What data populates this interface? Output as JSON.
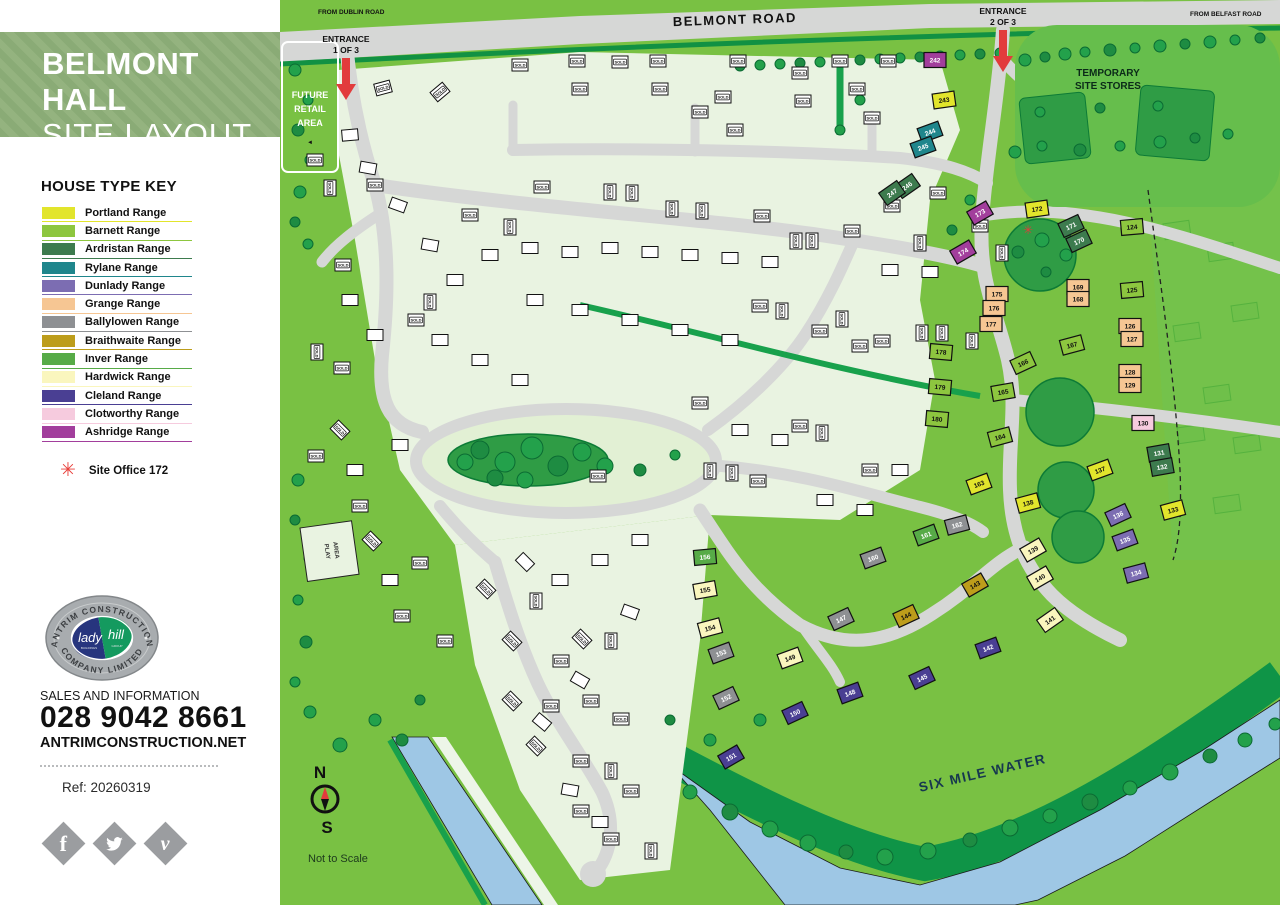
{
  "sidebar": {
    "title_line1": "BELMONT HALL",
    "title_line2": "SITE LAYOUT",
    "key_title": "HOUSE TYPE KEY",
    "key": [
      {
        "label": "Portland Range",
        "color": "#e2e52c",
        "text": "#111111"
      },
      {
        "label": "Barnett Range",
        "color": "#8dc63f",
        "text": "#111111"
      },
      {
        "label": "Ardristan Range",
        "color": "#3d7b4e",
        "text": "#ffffff"
      },
      {
        "label": "Rylane Range",
        "color": "#1f868c",
        "text": "#ffffff"
      },
      {
        "label": "Dunlady Range",
        "color": "#7c6db2",
        "text": "#ffffff"
      },
      {
        "label": "Grange Range",
        "color": "#f6c693",
        "text": "#111111"
      },
      {
        "label": "Ballylowen Range",
        "color": "#8e9093",
        "text": "#ffffff"
      },
      {
        "label": "Braithwaite Range",
        "color": "#bd9d1b",
        "text": "#111111"
      },
      {
        "label": "Inver Range",
        "color": "#57ab47",
        "text": "#ffffff"
      },
      {
        "label": "Hardwick Range",
        "color": "#faf6be",
        "text": "#111111"
      },
      {
        "label": "Cleland Range",
        "color": "#4a3f93",
        "text": "#ffffff"
      },
      {
        "label": "Clotworthy Range",
        "color": "#f6cbde",
        "text": "#111111"
      },
      {
        "label": "Ashridge Range",
        "color": "#a23e9c",
        "text": "#ffffff"
      }
    ],
    "site_office_label": "Site Office 172",
    "site_office_symbol": "✳",
    "logo": {
      "arc_top": "ANTRIM CONSTRUCTION",
      "arc_bottom": "COMPANY LIMITED",
      "script_left": "lady",
      "script_right": "hill",
      "sub_left": "BUILDINGS",
      "sub_right": "GROUP"
    },
    "sales_label": "SALES AND INFORMATION",
    "phone": "028 9042 8661",
    "website": "ANTRIMCONSTRUCTION.NET",
    "ref": "Ref: 20260319",
    "social": [
      "facebook",
      "twitter",
      "vimeo"
    ]
  },
  "map": {
    "labels": {
      "belmont_road": "BELMONT ROAD",
      "from_dublin": "FROM DUBLIN ROAD",
      "from_belfast": "FROM BELFAST ROAD",
      "entrance": "ENTRANCE",
      "entrance1_sub": "1 OF 3",
      "entrance2_sub": "2 OF 3",
      "future_retail_1": "FUTURE",
      "future_retail_2": "RETAIL",
      "future_retail_3": "AREA",
      "stores_1": "TEMPORARY",
      "stores_2": "SITE STORES",
      "six_mile_water": "SIX MILE WATER",
      "play_area_1": "PLAY",
      "play_area_2": "AREA",
      "compass_n": "N",
      "compass_s": "S",
      "not_to_scale": "Not to Scale",
      "sold": "SOLD",
      "site_office_symbol": "✳"
    },
    "colors": {
      "grass": "#79c143",
      "future_field": "#74c24b",
      "road": "#d6d7d6",
      "dev": "#e9f3e1",
      "river": "#9ec7e5",
      "bank": "#0f9447",
      "tree": "#23a14b",
      "tree_dark": "#0d7b36",
      "red": "#e23b3c"
    },
    "plots": [
      [
        "242",
        655,
        60,
        0,
        12
      ],
      [
        "243",
        664,
        100,
        -8,
        0
      ],
      [
        "244",
        650,
        132,
        -20,
        3
      ],
      [
        "245",
        643,
        147,
        -20,
        3
      ],
      [
        "246",
        627,
        186,
        -35,
        2
      ],
      [
        "247",
        612,
        193,
        -35,
        2
      ],
      [
        "173",
        700,
        213,
        -30,
        12
      ],
      [
        "174",
        683,
        252,
        -30,
        12
      ],
      [
        "172",
        757,
        209,
        -8,
        0
      ],
      [
        "171",
        791,
        226,
        -25,
        2
      ],
      [
        "170",
        799,
        241,
        -25,
        2
      ],
      [
        "124",
        852,
        227,
        -5,
        1
      ],
      [
        "175",
        717,
        294,
        0,
        5
      ],
      [
        "176",
        714,
        308,
        0,
        5
      ],
      [
        "177",
        711,
        324,
        0,
        5
      ],
      [
        "169",
        798,
        287,
        0,
        5
      ],
      [
        "168",
        798,
        299,
        0,
        5
      ],
      [
        "125",
        852,
        290,
        -5,
        1
      ],
      [
        "126",
        850,
        326,
        0,
        5
      ],
      [
        "127",
        852,
        339,
        0,
        5
      ],
      [
        "178",
        661,
        352,
        5,
        1
      ],
      [
        "179",
        660,
        387,
        5,
        1
      ],
      [
        "180",
        657,
        419,
        5,
        1
      ],
      [
        "167",
        792,
        345,
        -15,
        1
      ],
      [
        "166",
        743,
        363,
        -25,
        1
      ],
      [
        "165",
        723,
        392,
        -10,
        1
      ],
      [
        "164",
        720,
        437,
        -15,
        1
      ],
      [
        "163",
        699,
        484,
        -20,
        0
      ],
      [
        "128",
        850,
        372,
        0,
        5
      ],
      [
        "129",
        850,
        385,
        0,
        5
      ],
      [
        "130",
        863,
        423,
        0,
        11
      ],
      [
        "131",
        879,
        453,
        -10,
        2
      ],
      [
        "132",
        882,
        467,
        -10,
        2
      ],
      [
        "133",
        893,
        510,
        -15,
        0
      ],
      [
        "137",
        820,
        470,
        -20,
        0
      ],
      [
        "138",
        748,
        503,
        -15,
        0
      ],
      [
        "136",
        838,
        515,
        -25,
        4
      ],
      [
        "135",
        845,
        540,
        -20,
        4
      ],
      [
        "134",
        856,
        573,
        -15,
        4
      ],
      [
        "139",
        753,
        550,
        -30,
        9
      ],
      [
        "140",
        760,
        578,
        -30,
        9
      ],
      [
        "141",
        770,
        620,
        -35,
        9
      ],
      [
        "143",
        695,
        585,
        -30,
        7
      ],
      [
        "144",
        626,
        616,
        -25,
        7
      ],
      [
        "142",
        708,
        648,
        -20,
        10
      ],
      [
        "145",
        642,
        678,
        -25,
        10
      ],
      [
        "148",
        570,
        693,
        -20,
        10
      ],
      [
        "150",
        515,
        713,
        -25,
        10
      ],
      [
        "151",
        451,
        757,
        -30,
        10
      ],
      [
        "149",
        510,
        658,
        -20,
        9
      ],
      [
        "147",
        561,
        619,
        -25,
        6
      ],
      [
        "160",
        593,
        558,
        -20,
        6
      ],
      [
        "162",
        677,
        525,
        -15,
        6
      ],
      [
        "161",
        646,
        535,
        -20,
        8
      ],
      [
        "152",
        446,
        698,
        -25,
        6
      ],
      [
        "153",
        441,
        653,
        -20,
        6
      ],
      [
        "154",
        430,
        628,
        -15,
        9
      ],
      [
        "155",
        425,
        590,
        -10,
        9
      ],
      [
        "156",
        425,
        557,
        -5,
        8
      ]
    ],
    "sold_houses": [
      [
        103,
        88,
        -15
      ],
      [
        160,
        92,
        -40
      ],
      [
        240,
        65,
        0
      ],
      [
        297,
        61,
        0
      ],
      [
        300,
        89,
        0
      ],
      [
        340,
        62,
        0
      ],
      [
        378,
        61,
        0
      ],
      [
        380,
        89,
        0
      ],
      [
        420,
        112,
        0
      ],
      [
        443,
        97,
        0
      ],
      [
        458,
        61,
        0
      ],
      [
        455,
        130,
        0
      ],
      [
        520,
        73,
        0
      ],
      [
        523,
        101,
        0
      ],
      [
        560,
        61,
        0
      ],
      [
        577,
        89,
        0
      ],
      [
        592,
        118,
        0
      ],
      [
        608,
        61,
        0
      ],
      [
        35,
        160,
        0
      ],
      [
        50,
        188,
        90
      ],
      [
        95,
        185,
        0
      ],
      [
        63,
        265,
        0
      ],
      [
        37,
        352,
        90
      ],
      [
        62,
        368,
        0
      ],
      [
        150,
        302,
        90
      ],
      [
        136,
        320,
        0
      ],
      [
        190,
        215,
        0
      ],
      [
        230,
        227,
        90
      ],
      [
        262,
        187,
        0
      ],
      [
        330,
        192,
        90
      ],
      [
        352,
        193,
        90
      ],
      [
        392,
        209,
        90
      ],
      [
        422,
        211,
        90
      ],
      [
        482,
        216,
        0
      ],
      [
        516,
        241,
        90
      ],
      [
        532,
        241,
        90
      ],
      [
        572,
        231,
        0
      ],
      [
        612,
        206,
        0
      ],
      [
        640,
        243,
        90
      ],
      [
        658,
        193,
        0
      ],
      [
        700,
        226,
        0
      ],
      [
        722,
        253,
        90
      ],
      [
        480,
        306,
        0
      ],
      [
        502,
        311,
        90
      ],
      [
        540,
        331,
        0
      ],
      [
        562,
        319,
        90
      ],
      [
        602,
        341,
        0
      ],
      [
        642,
        333,
        90
      ],
      [
        662,
        333,
        90
      ],
      [
        692,
        341,
        90
      ],
      [
        580,
        346,
        0
      ],
      [
        420,
        403,
        0
      ],
      [
        520,
        426,
        0
      ],
      [
        542,
        433,
        90
      ],
      [
        318,
        476,
        0
      ],
      [
        430,
        471,
        90
      ],
      [
        452,
        473,
        90
      ],
      [
        478,
        481,
        0
      ],
      [
        590,
        470,
        0
      ],
      [
        60,
        430,
        45
      ],
      [
        36,
        456,
        0
      ],
      [
        80,
        506,
        0
      ],
      [
        92,
        541,
        45
      ],
      [
        140,
        563,
        0
      ],
      [
        206,
        589,
        45
      ],
      [
        232,
        641,
        45
      ],
      [
        165,
        641,
        0
      ],
      [
        122,
        616,
        0
      ],
      [
        256,
        601,
        90
      ],
      [
        281,
        661,
        0
      ],
      [
        302,
        639,
        45
      ],
      [
        331,
        641,
        90
      ],
      [
        232,
        701,
        45
      ],
      [
        271,
        706,
        0
      ],
      [
        311,
        701,
        0
      ],
      [
        341,
        719,
        0
      ],
      [
        256,
        746,
        45
      ],
      [
        301,
        761,
        0
      ],
      [
        331,
        771,
        90
      ],
      [
        351,
        791,
        0
      ],
      [
        301,
        811,
        0
      ],
      [
        331,
        839,
        0
      ],
      [
        371,
        851,
        90
      ]
    ],
    "houses": [
      [
        70,
        135,
        -5
      ],
      [
        88,
        168,
        10
      ],
      [
        118,
        205,
        20
      ],
      [
        150,
        245,
        10
      ],
      [
        175,
        280,
        0
      ],
      [
        70,
        300,
        0
      ],
      [
        95,
        335,
        0
      ],
      [
        210,
        255,
        0
      ],
      [
        250,
        248,
        0
      ],
      [
        290,
        252,
        0
      ],
      [
        330,
        248,
        0
      ],
      [
        370,
        252,
        0
      ],
      [
        410,
        255,
        0
      ],
      [
        450,
        258,
        0
      ],
      [
        490,
        262,
        0
      ],
      [
        255,
        300,
        0
      ],
      [
        300,
        310,
        0
      ],
      [
        350,
        320,
        0
      ],
      [
        400,
        330,
        0
      ],
      [
        450,
        340,
        0
      ],
      [
        610,
        270,
        0
      ],
      [
        650,
        272,
        0
      ],
      [
        160,
        340,
        0
      ],
      [
        200,
        360,
        0
      ],
      [
        240,
        380,
        0
      ],
      [
        120,
        445,
        0
      ],
      [
        460,
        430,
        0
      ],
      [
        500,
        440,
        0
      ],
      [
        360,
        540,
        0
      ],
      [
        320,
        560,
        0
      ],
      [
        280,
        580,
        0
      ],
      [
        245,
        562,
        45
      ],
      [
        350,
        612,
        20
      ],
      [
        300,
        680,
        30
      ],
      [
        262,
        722,
        40
      ],
      [
        290,
        790,
        10
      ],
      [
        320,
        822,
        0
      ],
      [
        110,
        580,
        0
      ],
      [
        75,
        470,
        0
      ],
      [
        545,
        500,
        0
      ],
      [
        585,
        510,
        0
      ],
      [
        620,
        470,
        0
      ]
    ],
    "trees": [
      [
        460,
        66,
        5
      ],
      [
        480,
        65,
        5
      ],
      [
        500,
        64,
        5
      ],
      [
        520,
        63,
        5
      ],
      [
        540,
        62,
        5
      ],
      [
        560,
        61,
        5
      ],
      [
        580,
        60,
        5
      ],
      [
        600,
        59,
        5
      ],
      [
        620,
        58,
        5
      ],
      [
        640,
        57,
        5
      ],
      [
        660,
        56,
        5
      ],
      [
        680,
        55,
        5
      ],
      [
        700,
        54,
        5
      ],
      [
        720,
        53,
        5
      ],
      [
        745,
        60,
        6
      ],
      [
        765,
        57,
        5
      ],
      [
        785,
        54,
        6
      ],
      [
        805,
        52,
        5
      ],
      [
        830,
        50,
        6
      ],
      [
        855,
        48,
        5
      ],
      [
        880,
        46,
        6
      ],
      [
        905,
        44,
        5
      ],
      [
        930,
        42,
        6
      ],
      [
        955,
        40,
        5
      ],
      [
        980,
        38,
        5
      ],
      [
        15,
        70,
        6
      ],
      [
        28,
        100,
        5
      ],
      [
        18,
        130,
        6
      ],
      [
        30,
        160,
        5
      ],
      [
        20,
        192,
        6
      ],
      [
        15,
        222,
        5
      ],
      [
        28,
        244,
        5
      ],
      [
        18,
        480,
        6
      ],
      [
        15,
        520,
        5
      ],
      [
        30,
        558,
        6
      ],
      [
        18,
        600,
        5
      ],
      [
        26,
        642,
        6
      ],
      [
        15,
        682,
        5
      ],
      [
        30,
        712,
        6
      ],
      [
        200,
        450,
        9
      ],
      [
        225,
        462,
        10
      ],
      [
        252,
        448,
        11
      ],
      [
        278,
        466,
        10
      ],
      [
        302,
        452,
        9
      ],
      [
        325,
        466,
        8
      ],
      [
        215,
        478,
        8
      ],
      [
        245,
        480,
        8
      ],
      [
        185,
        462,
        8
      ],
      [
        360,
        470,
        6
      ],
      [
        395,
        455,
        5
      ],
      [
        410,
        792,
        7
      ],
      [
        450,
        812,
        8
      ],
      [
        490,
        829,
        8
      ],
      [
        528,
        843,
        8
      ],
      [
        566,
        852,
        7
      ],
      [
        605,
        857,
        8
      ],
      [
        648,
        851,
        8
      ],
      [
        690,
        840,
        7
      ],
      [
        730,
        828,
        8
      ],
      [
        770,
        816,
        7
      ],
      [
        810,
        802,
        8
      ],
      [
        850,
        788,
        7
      ],
      [
        890,
        772,
        8
      ],
      [
        930,
        756,
        7
      ],
      [
        965,
        740,
        7
      ],
      [
        995,
        724,
        6
      ],
      [
        738,
        252,
        6
      ],
      [
        762,
        240,
        7
      ],
      [
        786,
        255,
        6
      ],
      [
        766,
        272,
        5
      ],
      [
        735,
        152,
        6
      ],
      [
        762,
        146,
        5
      ],
      [
        800,
        150,
        6
      ],
      [
        840,
        146,
        5
      ],
      [
        880,
        142,
        6
      ],
      [
        915,
        138,
        5
      ],
      [
        948,
        134,
        5
      ],
      [
        760,
        112,
        5
      ],
      [
        820,
        108,
        5
      ],
      [
        878,
        106,
        5
      ],
      [
        690,
        200,
        5
      ],
      [
        672,
        230,
        5
      ],
      [
        580,
        100,
        5
      ],
      [
        560,
        130,
        5
      ],
      [
        122,
        740,
        6
      ],
      [
        95,
        720,
        6
      ],
      [
        60,
        745,
        7
      ],
      [
        140,
        700,
        5
      ],
      [
        480,
        720,
        6
      ],
      [
        430,
        740,
        6
      ],
      [
        390,
        720,
        5
      ]
    ],
    "greens": [
      [
        760,
        255,
        36
      ],
      [
        780,
        412,
        34
      ],
      [
        786,
        490,
        28
      ],
      [
        798,
        537,
        26
      ]
    ]
  }
}
